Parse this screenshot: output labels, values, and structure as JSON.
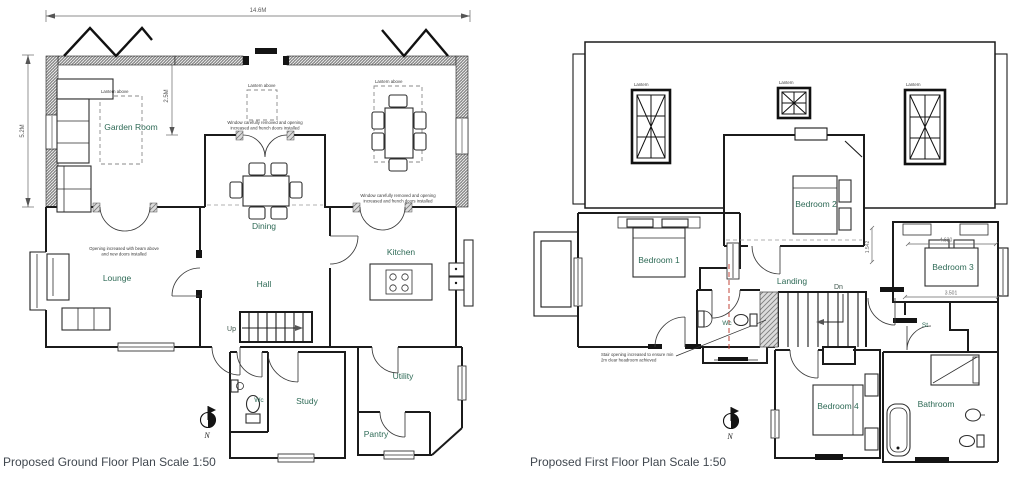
{
  "colors": {
    "background": "#ffffff",
    "wall_line": "#1b1b1b",
    "room_label": "#2e6a56",
    "title_text": "#40474f",
    "dimension_text": "#5a5a5a",
    "section_line": "#c2453a",
    "hatch_gray": "#808080"
  },
  "ground_floor": {
    "title": "Proposed Ground Floor Plan Scale 1:50",
    "north_label": "N",
    "dimensions": {
      "overall_width": "14.6M",
      "overall_depth": "5.2M",
      "garden_room_depth": "2.5M"
    },
    "rooms": {
      "garden_room": "Garden Room",
      "dining": "Dining",
      "lounge": "Lounge",
      "hall": "Hall",
      "kitchen": "Kitchen",
      "study": "Study",
      "utility": "Utility",
      "pantry": "Pantry",
      "wc": "Wc"
    },
    "stairs_label": "Up",
    "notes": {
      "lantern_above": "Lantern above",
      "window_note_line1": "Window carefully removed and opening",
      "window_note_line2": "increased and french doors installed",
      "lounge_note_line1": "Opening increased with beam above",
      "lounge_note_line2": "and new doors installed"
    }
  },
  "first_floor": {
    "title": "Proposed First Floor Plan Scale 1:50",
    "north_label": "N",
    "dimensions": {
      "bedroom3_width": "4.630",
      "landing_width": "3.501",
      "side_offset": "1.542"
    },
    "rooms": {
      "bedroom1": "Bedroom 1",
      "bedroom2": "Bedroom 2",
      "bedroom3": "Bedroom 3",
      "bedroom4": "Bedroom 4",
      "landing": "Landing",
      "bathroom": "Bathroom",
      "wc": "Wc",
      "store": "St"
    },
    "stairs_label": "Dn",
    "notes": {
      "lantern": "Lantern",
      "stair_note_line1": "Stair opening increased to ensure min",
      "stair_note_line2": "2m clear headroom achieved"
    }
  }
}
